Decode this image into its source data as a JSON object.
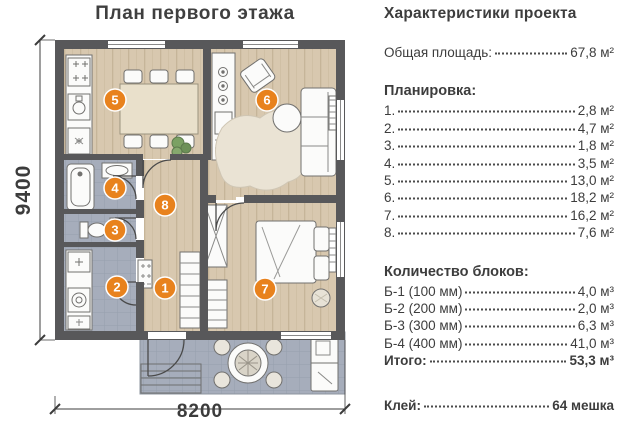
{
  "plan": {
    "title": "План первого этажа",
    "dim_height": "9400",
    "dim_width": "8200",
    "room_markers": [
      "1",
      "2",
      "3",
      "4",
      "5",
      "6",
      "7",
      "8"
    ],
    "marker_color": "#e8821d",
    "wall_color": "#58585a",
    "wood_color": "#d8c8af",
    "tile_color": "#a6adbb"
  },
  "panel": {
    "title": "Характеристики проекта",
    "total_area": {
      "label": "Общая площадь:",
      "value": "67,8 м²"
    },
    "layout_header": "Планировка:",
    "layout_items": [
      {
        "label": "1.",
        "value": "2,8 м²"
      },
      {
        "label": "2.",
        "value": "4,7 м²"
      },
      {
        "label": "3.",
        "value": "1,8 м²"
      },
      {
        "label": "4.",
        "value": "3,5 м²"
      },
      {
        "label": "5.",
        "value": "13,0 м²"
      },
      {
        "label": "6.",
        "value": "18,2 м²"
      },
      {
        "label": "7.",
        "value": "16,2 м²"
      },
      {
        "label": "8.",
        "value": "7,6 м²"
      }
    ],
    "blocks_header": "Количество блоков:",
    "block_items": [
      {
        "label": "Б-1 (100 мм)",
        "value": "4,0 м³"
      },
      {
        "label": "Б-2 (200 мм)",
        "value": "2,0 м³"
      },
      {
        "label": "Б-3 (300 мм)",
        "value": "6,3 м³"
      },
      {
        "label": "Б-4 (400 мм)",
        "value": "41,0 м³"
      }
    ],
    "blocks_total": {
      "label": "Итого:",
      "value": "53,3 м³"
    },
    "glue": {
      "label": "Клей:",
      "value": "64 мешка"
    }
  }
}
